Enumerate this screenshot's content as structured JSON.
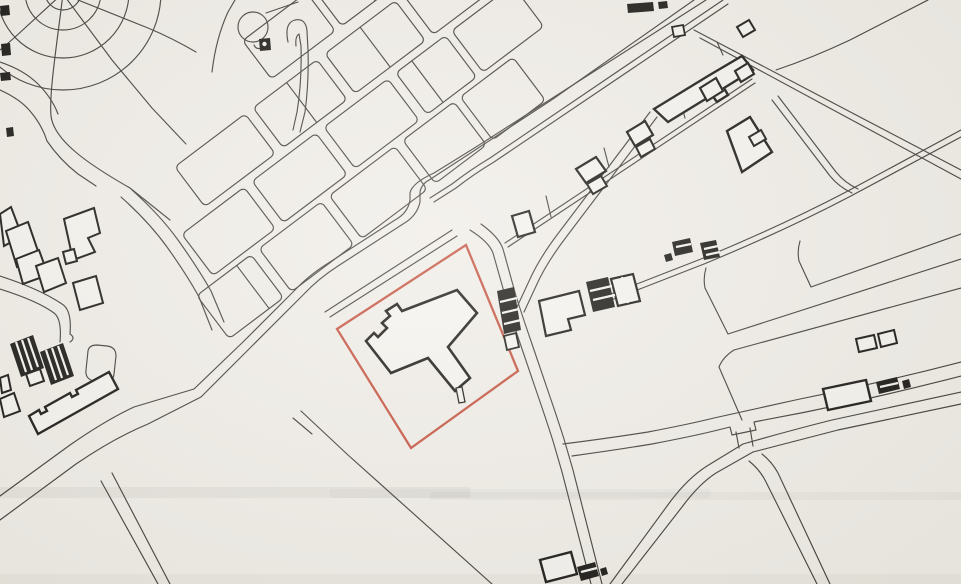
{
  "canvas": {
    "width": 961,
    "height": 584,
    "background": "#f0ede7"
  },
  "palette": {
    "line": "#3d3a35",
    "building_stroke": "#15130f",
    "building_fill": "#f5f3ee",
    "boundary_red": "#c44f3a",
    "stripe_white": "#f5f3ee",
    "band_gray": "#8e8b84"
  },
  "map": {
    "circles": [
      {
        "name": "park-ring-inner",
        "cx": 63,
        "cy": -8,
        "r": 18
      },
      {
        "name": "park-ring-mid",
        "cx": 63,
        "cy": -8,
        "r": 38
      },
      {
        "name": "park-ring-outer",
        "cx": 63,
        "cy": -8,
        "r": 66
      },
      {
        "name": "park-ring-fourth",
        "cx": 63,
        "cy": -8,
        "r": 98
      },
      {
        "name": "roundabout-circle",
        "cx": 253,
        "cy": 27,
        "r": 15
      }
    ],
    "block_frame": {
      "angle": -37,
      "cx": 350,
      "cy": 150
    },
    "blocks": [
      [
        -20,
        -152,
        80,
        48
      ],
      [
        68,
        -152,
        92,
        48
      ],
      [
        -150,
        -92,
        88,
        50
      ],
      [
        -52,
        -92,
        80,
        50
      ],
      [
        38,
        -92,
        88,
        50
      ],
      [
        136,
        -92,
        66,
        50
      ],
      [
        -185,
        -34,
        78,
        52
      ],
      [
        -97,
        -34,
        80,
        52
      ],
      [
        -7,
        -34,
        80,
        52
      ],
      [
        83,
        -34,
        62,
        52
      ],
      [
        153,
        -34,
        76,
        52
      ],
      [
        -210,
        24,
        68,
        54
      ],
      [
        -132,
        24,
        78,
        54
      ],
      [
        -44,
        24,
        82,
        54
      ],
      [
        48,
        24,
        64,
        54
      ],
      [
        120,
        24,
        66,
        54
      ]
    ],
    "block_dividers": [
      "M 110,-152 L 110,-104",
      "M -10,-92 L -10,-42",
      "M 82,-92 L 82,-42",
      "M 103,-34 L 103,18",
      "M -160,24 L -160,78"
    ],
    "thin_paths": [
      {
        "name": "park-spoke-sw",
        "d": "M 62,-6 L 14,38 L 0,50"
      },
      {
        "name": "park-spoke-south",
        "d": "M 63,-6 C 56,50 49,95 51,116 C 54,140 86,163 130,188 L 170,220"
      },
      {
        "name": "park-spoke-se",
        "d": "M 63,-6 L 112,60 L 152,108 L 186,144"
      },
      {
        "name": "park-spoke-east",
        "d": "M 78,0 L 148,28 Q 172,38 196,52"
      },
      {
        "name": "park-roundabout-path",
        "d": "M 212,72 Q 216,38 228,12 L 235,0"
      },
      {
        "name": "roundabout-link-north",
        "d": "M 266,13 L 298,2"
      },
      {
        "name": "street-lobe-end",
        "d": "M 288,42 Q 284,23 295,20 Q 306,18 307,31 L 308,50 Q 309,82 305,112 L 300,132"
      },
      {
        "name": "street-lobe-inner",
        "d": "M 296,46 Q 295,36 299,34 L 301,46 Q 302,82 297,112 L 293,130"
      },
      {
        "name": "left-edge-curve-a",
        "d": "M 0,62 Q 24,70 38,84 Q 52,98 58,114"
      },
      {
        "name": "left-edge-curve-b",
        "d": "M 0,90 Q 20,99 30,111 Q 42,125 47,141"
      },
      {
        "name": "left-street",
        "d": "M 47,141 Q 60,160 78,174 L 96,186"
      },
      {
        "name": "houses-street-a",
        "d": "M 132,190 Q 160,215 178,240 Q 198,268 211,291 L 224,322"
      },
      {
        "name": "houses-street-b",
        "d": "M 121,197 Q 149,222 167,247 Q 187,275 199,297 L 212,330"
      },
      {
        "name": "curved-street-a",
        "d": "M 0,276 Q 40,289 62,304 Q 72,310 70,334 Q 76,338 70,342"
      },
      {
        "name": "curved-street-b",
        "d": "M 0,289 Q 38,301 54,313 Q 62,319 60,342"
      },
      {
        "name": "hammerhead-loop",
        "d": "M 88,351 L 86,370 Q 85,379 94,381 L 104,382 Q 113,383 114,374 L 116,356 Q 116,347 107,346 L 97,345 Q 89,345 88,351 Z"
      },
      {
        "name": "road-main-nw-edge",
        "d": "M 706,0 L 565,90 L 476,147 L 434,173 Q 412,183 410,193 L 410,200 Q 408,213 395,220 L 330,262 Q 309,275 295,290 L 244,341 L 194,389"
      },
      {
        "name": "road-main-se-edge",
        "d": "M 694,0 L 553,99 L 466,156 L 426,182 Q 421,186 420,192 L 420,202 Q 417,216 403,224 L 338,266 Q 318,279 304,294 L 253,345 L 201,397"
      },
      {
        "name": "rail-track-a",
        "d": "M 723,0 L 490,158 Q 470,170 452,184 L 430,198"
      },
      {
        "name": "rail-track-b",
        "d": "M 728,4 L 494,162 Q 474,174 456,188 L 434,202"
      },
      {
        "name": "verge-line-a",
        "d": "M 452,230 L 325,312"
      },
      {
        "name": "verge-line-b",
        "d": "M 457,236 L 330,317"
      },
      {
        "name": "road-east-site-a",
        "d": "M 470,230 Q 489,242 493,253 L 506,299 Q 513,323 521,346 L 537,393 Q 546,419 553,441 L 562,472 L 591,584"
      },
      {
        "name": "road-east-site-b",
        "d": "M 481,224 Q 499,237 503,249 L 516,296 Q 524,321 532,344 L 548,391 Q 557,417 564,439 L 573,470 L 602,584"
      },
      {
        "name": "road-mid-diag-a",
        "d": "M 650,112 L 560,231 Q 540,257 530,279 L 517,307"
      },
      {
        "name": "road-mid-diag-b",
        "d": "M 657,117 L 567,236 Q 547,262 537,284 L 524,312"
      },
      {
        "name": "factory-chain-base-a",
        "d": "M 505,243 L 752,79"
      },
      {
        "name": "factory-chain-base-b",
        "d": "M 508,247 L 755,83"
      },
      {
        "name": "chain-tick-1",
        "d": "M 546,196 L 551,217"
      },
      {
        "name": "chain-tick-2",
        "d": "M 604,148 L 609,167"
      },
      {
        "name": "chain-tick-3",
        "d": "M 680,100 L 685,118"
      },
      {
        "name": "chain-tick-4",
        "d": "M 717,42 L 723,55"
      },
      {
        "name": "crossing-lane",
        "d": "M 301,411 L 348,455 L 492,584"
      },
      {
        "name": "crossing-stub",
        "d": "M 293,418 L 312,434"
      },
      {
        "name": "road-bl-nw-edge",
        "d": "M 0,496 L 70,445 Q 106,420 134,407 L 194,389"
      },
      {
        "name": "road-bl-se-edge",
        "d": "M 0,520 L 76,464 Q 114,438 148,424 L 201,397"
      },
      {
        "name": "road-to-bottom-a",
        "d": "M 112,473 L 170,584"
      },
      {
        "name": "road-to-bottom-b",
        "d": "M 101,481 L 158,584"
      },
      {
        "name": "ne-parcel-road-a",
        "d": "M 694,30 L 961,170"
      },
      {
        "name": "ne-parcel-road-b",
        "d": "M 700,38 L 961,179"
      },
      {
        "name": "ne-corner-line",
        "d": "M 928,0 L 850,40 Q 812,58 776,70"
      },
      {
        "name": "east-track-a",
        "d": "M 961,130 L 846,192 Q 781,226 701,259 L 642,282 L 603,297"
      },
      {
        "name": "east-track-b",
        "d": "M 961,137 L 849,197 Q 784,231 704,264 L 645,287 L 606,302"
      },
      {
        "name": "east-connector-a",
        "d": "M 772,100 L 830,176 Q 839,187 852,193"
      },
      {
        "name": "east-connector-b",
        "d": "M 778,96 L 836,172 Q 845,183 858,189"
      },
      {
        "name": "parcel-a-edge",
        "d": "M 800,241 Q 797,251 799,261 L 811,287 L 961,234"
      },
      {
        "name": "parcel-b-edge",
        "d": "M 706,268 Q 703,278 705,288 L 728,334 L 961,259"
      },
      {
        "name": "parcel-c-edge",
        "d": "M 734,350 L 961,288"
      },
      {
        "name": "parcel-c-left",
        "d": "M 734,350 Q 723,357 719,367 L 742,420"
      },
      {
        "name": "br-road-sw-a",
        "d": "M 610,584 L 670,502 Q 688,478 707,466 L 743,444"
      },
      {
        "name": "br-road-sw-b",
        "d": "M 622,584 L 682,507 Q 699,484 716,473 L 753,452"
      },
      {
        "name": "br-road-east-a",
        "d": "M 743,444 Q 792,430 832,420 L 961,392"
      },
      {
        "name": "br-road-east-b",
        "d": "M 753,452 Q 800,440 838,430 L 961,404"
      },
      {
        "name": "br-branch-a",
        "d": "M 749,461 Q 759,469 765,480 L 817,584"
      },
      {
        "name": "br-branch-b",
        "d": "M 762,454 Q 772,462 778,473 L 830,584"
      },
      {
        "name": "br-upper-road-a",
        "d": "M 563,444 Q 610,438 648,432 Q 690,424 714,418 L 800,399 Q 884,382 961,362"
      },
      {
        "name": "br-upper-road-b",
        "d": "M 572,456 Q 616,450 652,444 Q 694,436 718,430 L 730,427 L 732,435 L 756,430 L 754,422 L 806,412 Q 888,395 961,376"
      },
      {
        "name": "br-connector-a",
        "d": "M 736,432 L 739,448"
      },
      {
        "name": "br-connector-b",
        "d": "M 750,428 L 753,446"
      },
      {
        "name": "flag-tail",
        "d": "M 262,48 Q 256,50 254,45"
      }
    ],
    "site_boundary": {
      "name": "site-boundary",
      "d": "M 466,245 L 518,371 L 411,448 L 337,329 Z"
    },
    "outline_buildings": [
      {
        "name": "subject-building-t-shape",
        "w": 2.6,
        "d": "M 457,290 L 477,313 L 448,347 L 470,378 L 455,391 L 428,358 L 391,373 L 366,341 L 374,333 L 378,337 L 387,328 L 382,323 L 390,316 L 386,311 L 397,304 L 402,311 Z"
      },
      {
        "name": "subject-building-annex",
        "w": 1.3,
        "d": "M 456,388 L 462,387 L 465,402 L 459,403 Z"
      },
      {
        "name": "house-a",
        "w": 2,
        "d": "M 0,214 L 11,207 L 22,236 L 4,246 Z"
      },
      {
        "name": "house-b",
        "w": 2,
        "d": "M 6,231 L 28,222 L 40,257 L 17,267 Z"
      },
      {
        "name": "house-c",
        "w": 2,
        "d": "M 16,259 L 39,250 L 48,275 L 23,284 Z"
      },
      {
        "name": "house-d",
        "w": 2,
        "d": "M 36,266 L 58,258 L 66,283 L 44,292 Z"
      },
      {
        "name": "house-e",
        "w": 2,
        "d": "M 64,219 L 94,208 L 100,233 L 88,238 L 95,252 L 73,260 Z"
      },
      {
        "name": "house-f",
        "w": 2,
        "d": "M 63,252 L 74,249 L 77,261 L 66,264 Z"
      },
      {
        "name": "house-g",
        "w": 2,
        "d": "M 73,283 L 96,276 L 103,303 L 80,310 Z"
      },
      {
        "name": "house-h",
        "w": 2,
        "d": "M 0,399 L 14,393 L 20,411 L 4,417 Z"
      },
      {
        "name": "house-i",
        "w": 2,
        "d": "M 0,378 L 8,375 L 11,390 L 2,393 Z"
      },
      {
        "name": "house-j",
        "w": 2,
        "d": "M 26,374 L 40,369 L 44,381 L 30,386 Z"
      },
      {
        "name": "slab-block-building",
        "w": 2.4,
        "d": "M 29,416 L 39,410 L 41,414 L 47,411 L 45,407 L 70,393 L 72,397 L 78,394 L 76,390 L 109,372 L 118,389 L 38,434 Z"
      },
      {
        "name": "factory-long-building",
        "w": 2.4,
        "d": "M 654,109 L 708,76 L 742,56 L 753,70 L 724,88 L 728,95 L 717,102 L 712,95 L 668,122 Z"
      },
      {
        "name": "factory-building-2",
        "w": 2.4,
        "d": "M 727,131 L 750,117 L 772,152 L 742,172 Z"
      },
      {
        "name": "factory-building-2-bump",
        "w": 2,
        "d": "M 749,137 L 761,130 L 766,139 L 754,146 Z"
      },
      {
        "name": "factory-small-top",
        "w": 2,
        "d": "M 737,27 L 749,20 L 755,30 L 743,37 Z"
      },
      {
        "name": "small-rect-top",
        "w": 1.8,
        "d": "M 672,27 L 683,25 L 685,35 L 674,37 Z"
      },
      {
        "name": "chain-block-1",
        "w": 2.2,
        "d": "M 512,216 L 529,211 L 535,232 L 518,237 Z"
      },
      {
        "name": "chain-block-2",
        "w": 2.2,
        "d": "M 576,169 L 596,157 L 606,171 L 586,183 Z"
      },
      {
        "name": "chain-block-2b",
        "w": 2,
        "d": "M 587,184 L 601,176 L 607,186 L 593,194 Z"
      },
      {
        "name": "chain-block-3",
        "w": 2.2,
        "d": "M 627,132 L 645,121 L 653,135 L 635,146 Z"
      },
      {
        "name": "chain-block-3b",
        "w": 2,
        "d": "M 636,147 L 650,139 L 655,149 L 641,157 Z"
      },
      {
        "name": "chain-block-4",
        "w": 2.2,
        "d": "M 700,88 L 716,78 L 723,91 L 707,101 Z"
      },
      {
        "name": "chain-block-5",
        "w": 2.2,
        "d": "M 735,71 L 748,63 L 754,74 L 741,82 Z"
      },
      {
        "name": "outbuilding-white-small",
        "w": 1.8,
        "d": "M 504,336 L 516,333 L 519,347 L 507,350 Z"
      },
      {
        "name": "outbuilding-L-shape",
        "w": 2.2,
        "d": "M 539,301 L 579,291 L 585,315 L 568,319 L 571,330 L 546,336 Z"
      },
      {
        "name": "outbuilding-white-c",
        "w": 2.2,
        "d": "M 611,279 L 633,274 L 640,301 L 618,306 Z"
      },
      {
        "name": "right-mid-white-1",
        "w": 2,
        "d": "M 856,339 L 874,335 L 877,348 L 859,352 Z"
      },
      {
        "name": "right-mid-white-2",
        "w": 2,
        "d": "M 878,334 L 894,330 L 897,343 L 881,347 Z"
      },
      {
        "name": "br-slab-building",
        "w": 2.4,
        "d": "M 823,389 L 866,380 L 871,401 L 828,410 Z"
      },
      {
        "name": "bottom-white-building",
        "w": 2.4,
        "d": "M 540,560 L 571,552 L 577,574 L 546,582 Z"
      }
    ],
    "solid_buildings": [
      {
        "name": "edge-mark-1",
        "d": "M 0,6 L 9,5 L 10,15 L 1,16 Z"
      },
      {
        "name": "edge-mark-2",
        "d": "M 1,44 L 10,43 L 11,55 L 2,56 Z"
      },
      {
        "name": "edge-mark-3",
        "d": "M 0,73 L 10,72 L 11,80 L 1,81 Z"
      },
      {
        "name": "edge-mark-4",
        "d": "M 6,128 L 13,127 L 14,136 L 7,137 Z"
      },
      {
        "name": "roundabout-flag",
        "d": "M 259,39 L 270,38 L 271,50 L 260,51 Z"
      },
      {
        "name": "top-edge-bar-1",
        "d": "M 627,4 L 653,2 L 654,11 L 628,13 Z"
      },
      {
        "name": "top-edge-bar-2",
        "d": "M 658,2 L 667,1 L 668,8 L 659,9 Z"
      },
      {
        "name": "terrace-row-1",
        "d": "M 10,344 L 33,335 L 44,368 L 21,377 Z"
      },
      {
        "name": "terrace-row-2",
        "d": "M 40,352 L 63,343 L 74,376 L 51,385 Z"
      },
      {
        "name": "hatched-block-a",
        "d": "M 497,291 L 514,287 L 521,330 L 504,334 Z"
      },
      {
        "name": "hatched-block-b",
        "d": "M 586,282 L 608,277 L 615,307 L 593,312 Z"
      },
      {
        "name": "hatched-pair-1",
        "d": "M 672,242 L 690,238 L 693,252 L 675,256 Z"
      },
      {
        "name": "hatched-pair-2",
        "d": "M 700,243 L 716,240 L 720,257 L 704,260 Z"
      },
      {
        "name": "tiny-black-1",
        "d": "M 664,255 L 671,253 L 673,260 L 666,262 Z"
      },
      {
        "name": "br-hatched-building",
        "d": "M 876,382 L 897,377 L 900,389 L 879,394 Z"
      },
      {
        "name": "br-tiny-black",
        "d": "M 902,381 L 909,379 L 911,387 L 904,389 Z"
      },
      {
        "name": "bottom-hatched-building",
        "d": "M 577,567 L 595,562 L 599,576 L 581,581 Z"
      },
      {
        "name": "bottom-tiny-black",
        "d": "M 600,569 L 606,567 L 608,574 L 602,576 Z"
      }
    ],
    "white_stripes": [
      {
        "name": "terrace-1-stripes",
        "d": "M 16,342 L 26,372 M 22,340 L 32,370 M 28,338 L 38,367"
      },
      {
        "name": "terrace-2-stripes",
        "d": "M 46,350 L 56,380 M 52,348 L 62,378 M 58,346 L 68,375"
      },
      {
        "name": "hatched-a-stripes",
        "d": "M 500,302 L 517,298 M 502,313 L 519,309 M 504,324 L 521,320"
      },
      {
        "name": "hatched-b-stripes",
        "d": "M 590,291 L 612,286 M 593,300 L 615,295"
      },
      {
        "name": "hatched-pair-1-stripes",
        "d": "M 676,247 L 691,244"
      },
      {
        "name": "hatched-pair-2-stripes",
        "d": "M 704,249 L 718,246 M 706,255 L 720,252"
      },
      {
        "name": "br-hatched-stripes",
        "d": "M 880,387 L 898,383"
      },
      {
        "name": "bottom-hatched-stripes",
        "d": "M 581,572 L 597,568"
      },
      {
        "name": "whitec-divider",
        "d": "M 622,277 L 628,303"
      }
    ],
    "dots": [
      {
        "name": "flag-dot",
        "cx": 264.5,
        "cy": 44,
        "r": 2.2,
        "fill": "#f5f3ee"
      }
    ],
    "scan_bands": [
      [
        0,
        487,
        470,
        11,
        0.1
      ],
      [
        330,
        489,
        380,
        9,
        0.06
      ],
      [
        430,
        492,
        531,
        8,
        0.08
      ],
      [
        0,
        574,
        961,
        10,
        0.07
      ]
    ]
  }
}
